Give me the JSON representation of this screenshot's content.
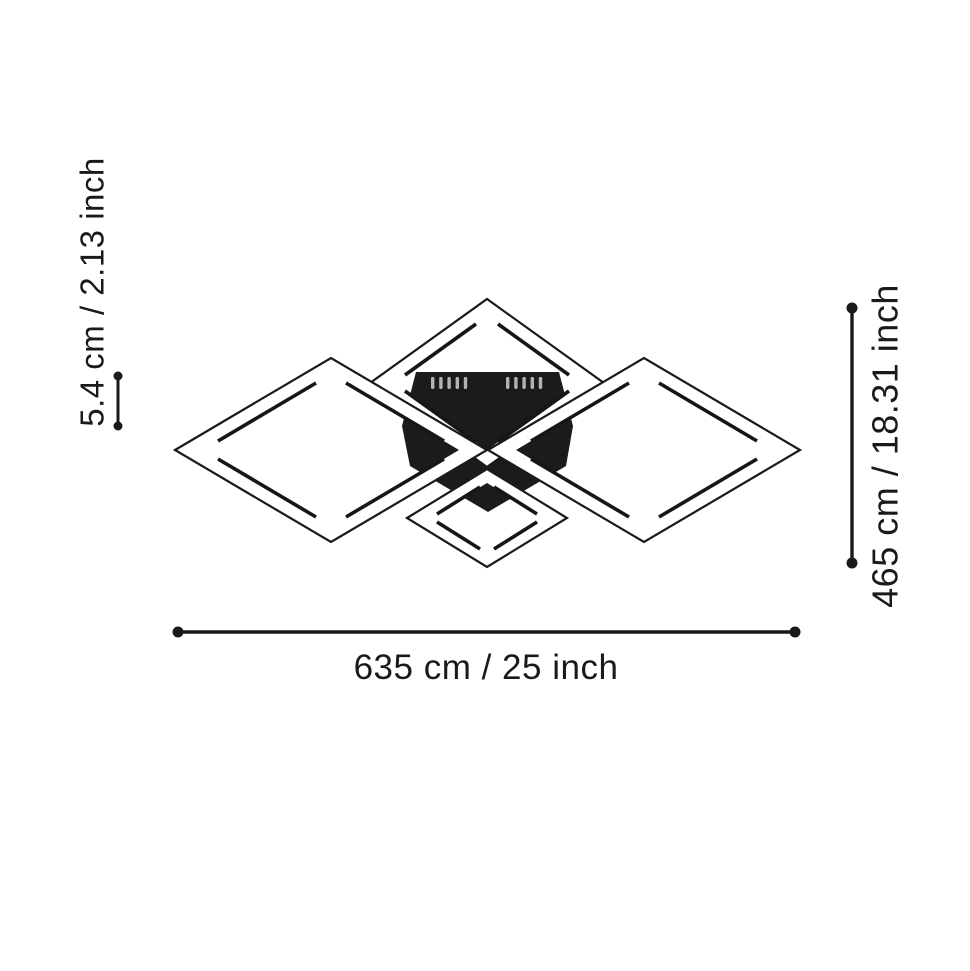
{
  "diagram": {
    "kind": "ceiling-light-dimension-diagram",
    "labels": {
      "frame_depth": "5.4 cm / 2.13 inch",
      "height": "465 cm / 18.31 inch",
      "width": "635 cm / 25 inch"
    },
    "colors": {
      "background": "#ffffff",
      "annotation": "#1a1a1a",
      "fixture_body": "#1b1b1b",
      "frame_band": "#ffffff",
      "vent_slot": "#b3b3b3"
    }
  }
}
